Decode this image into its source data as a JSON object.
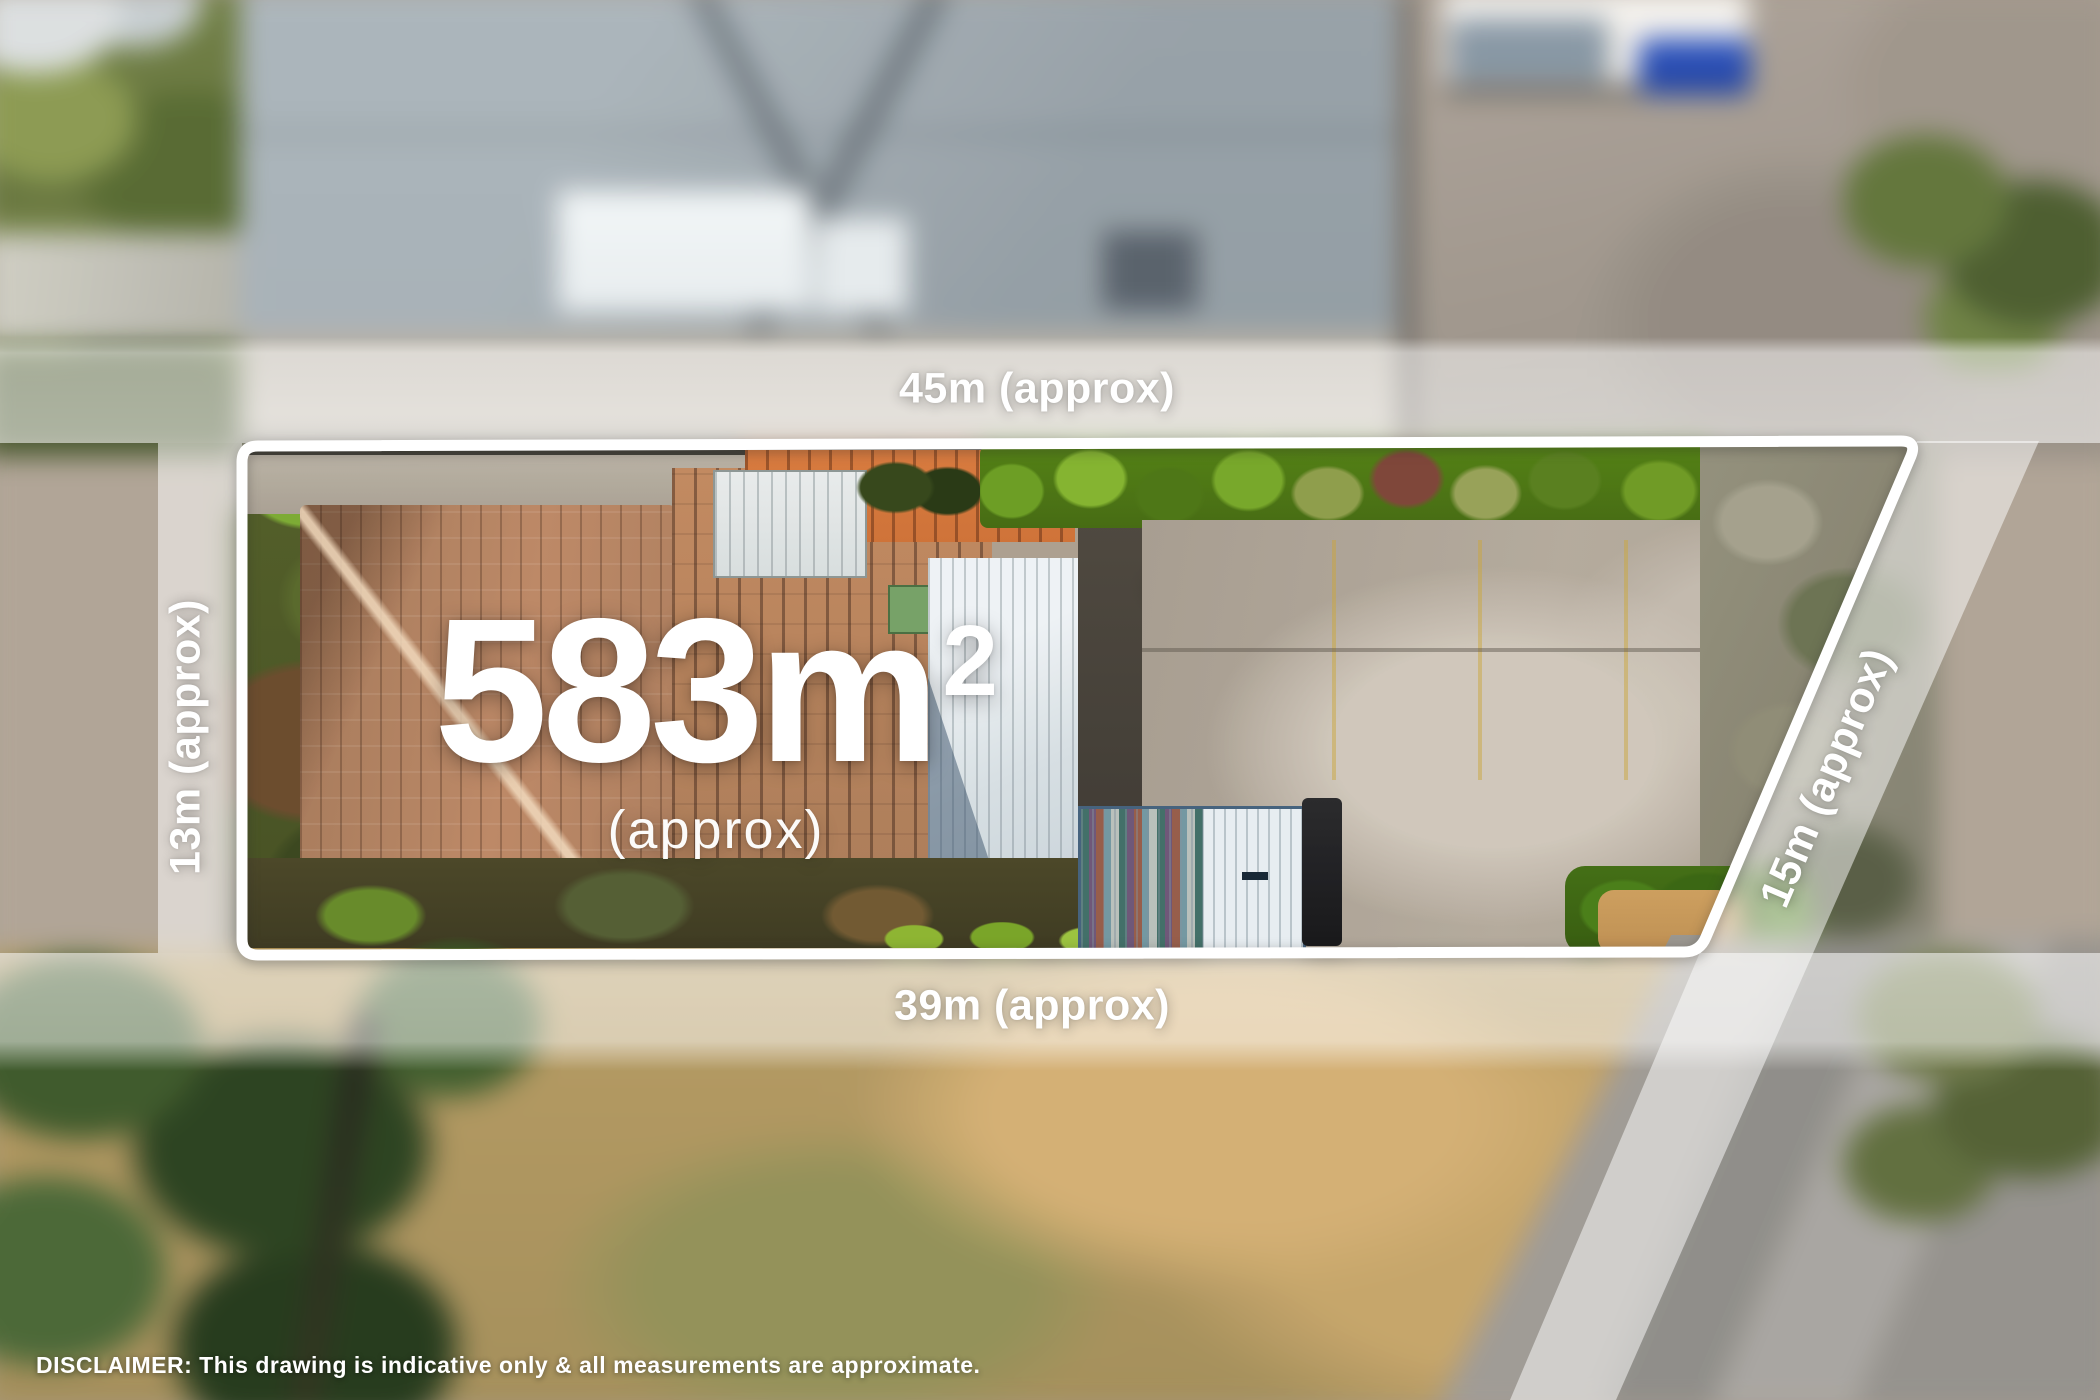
{
  "property": {
    "area": {
      "value": "583m",
      "sup": "2",
      "qualifier": "(approx)"
    },
    "boundaries": {
      "top": {
        "label": "45m (approx)"
      },
      "left": {
        "label": "13m (approx)"
      },
      "right": {
        "label": "15m (approx)"
      },
      "bottom": {
        "label": "39m (approx)"
      }
    }
  },
  "disclaimer": "DISCLAIMER: This drawing is indicative only & all measurements are approximate.",
  "style": {
    "boundary_line_color": "#ffffff",
    "label_text_color": "#ffffff",
    "measurement_band_color": "rgba(255,255,255,0.55)"
  }
}
